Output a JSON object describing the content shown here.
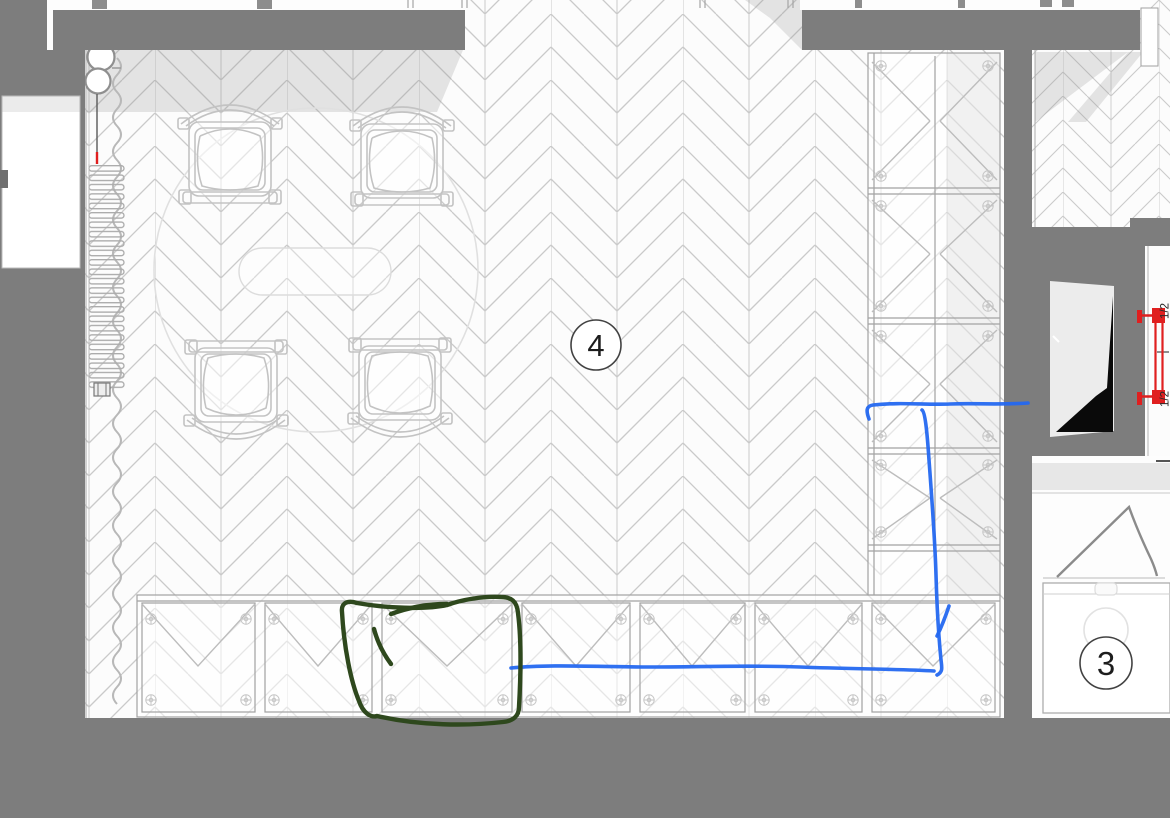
{
  "plan": {
    "rooms": [
      {
        "label": "4"
      },
      {
        "label": "3"
      }
    ],
    "dimension_labels": {
      "top": "1/2",
      "bottom": "1/2"
    }
  },
  "colors": {
    "wall": "#7d7d7d",
    "floor_bg": "#fcfcfc",
    "floor_line": "#cacaca",
    "annotation_blue": "#2468f0",
    "annotation_green": "#2e481d",
    "fixture_red": "#e01f1f",
    "shadow": "#9b9b9b"
  }
}
